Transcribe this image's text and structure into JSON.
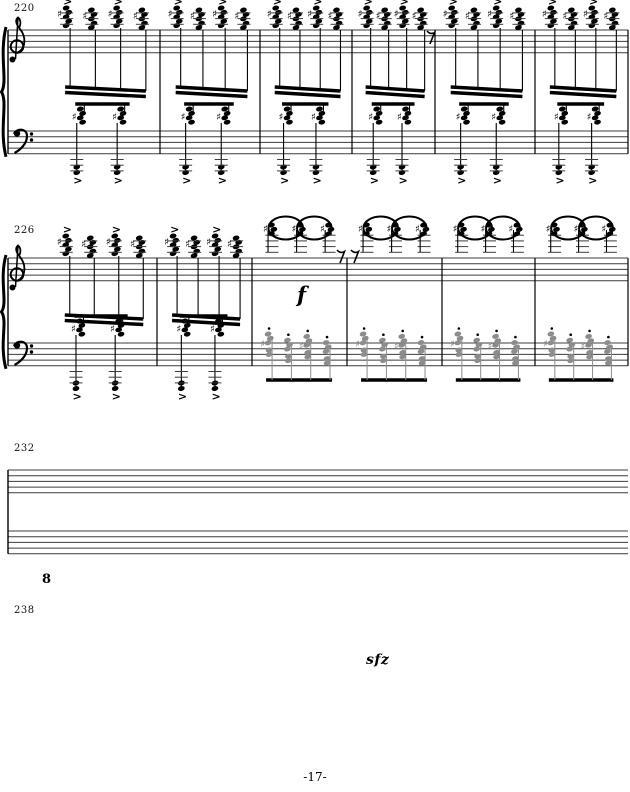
{
  "page": {
    "label": "-17-",
    "width": 630,
    "height": 792,
    "background": "#ffffff",
    "ink": "#000000",
    "gray_ink": "#8c8c8c",
    "staff_color": "#3c3c3c"
  },
  "dynamics": {
    "f": {
      "label": "f"
    },
    "sfz": {
      "label": "sfz"
    }
  },
  "icons": {
    "treble_clef": "treble-clef",
    "bass_clef": "bass-clef",
    "brace": "grand-staff-brace",
    "sharp": "sharp-sign",
    "accent": "accent-mark",
    "staccato": "staccato-dot",
    "eighth_rest": "eighth-rest"
  },
  "systems": [
    {
      "measure_number": "220",
      "treble_top": 30,
      "bass_top": 131,
      "content_left": 48,
      "oct_drop": 36,
      "barlines": [
        160,
        260,
        352,
        435,
        535,
        628
      ],
      "rests": [
        {
          "x": 427,
          "y": 31
        }
      ],
      "measures": [
        {
          "treble": "chords",
          "bass": "accent_oct"
        },
        {
          "treble": "chords",
          "bass": "accent_oct"
        },
        {
          "treble": "chords",
          "bass": "accent_oct"
        },
        {
          "treble": "chords",
          "bass": "accent_oct"
        },
        {
          "treble": "chords",
          "bass": "accent_oct"
        },
        {
          "treble": "chords",
          "bass": "accent_oct"
        }
      ]
    },
    {
      "measure_number": "226",
      "treble_top": 258,
      "bass_top": 343,
      "content_left": 48,
      "oct_drop": 40,
      "barlines": [
        157,
        252,
        347,
        442,
        535,
        628
      ],
      "rests": [
        {
          "x": 337,
          "y": 250
        },
        {
          "x": 351,
          "y": 250
        }
      ],
      "measures": [
        {
          "treble": "chords",
          "bass": "accent_oct"
        },
        {
          "treble": "chords",
          "bass": "accent_oct"
        },
        {
          "treble": "high_ties",
          "bass": "gray_stacc"
        },
        {
          "treble": "high_ties",
          "bass": "gray_stacc"
        },
        {
          "treble": "high_ties",
          "bass": "gray_stacc"
        },
        {
          "treble": "high_ties",
          "bass": "gray_stacc"
        }
      ]
    },
    {
      "measure_number": "232",
      "treble_top": 470,
      "bass_top": 531,
      "content_left": 48,
      "oct_drop": 40,
      "ottava": {
        "label": "",
        "segments": [
          {
            "x1": 148,
            "x2": 330,
            "y": 426,
            "tick": true
          },
          {
            "x1": 342,
            "x2": 628,
            "y": 426,
            "tick": false
          }
        ]
      },
      "measures": [
        {
          "treble": "loops",
          "bass": "gray_stacc"
        },
        {
          "treble": "run16",
          "bass": "gray_stacc"
        },
        {
          "treble": "run16",
          "bass": "gray_stacc"
        },
        {
          "treble": "run16",
          "bass": "gray_stacc"
        },
        {
          "treble": "loops",
          "bass": "gray_stacc"
        },
        {
          "treble": "run16",
          "bass": "gray_stacc"
        }
      ]
    },
    {
      "measure_number": "238",
      "treble_top": 630,
      "bass_top": 697,
      "content_left": 48,
      "oct_drop": 52,
      "ottava": {
        "label": "8",
        "segments": [
          {
            "x1": 58,
            "x2": 292,
            "y": 583,
            "tick": true
          },
          {
            "x1": 310,
            "x2": 628,
            "y": 598,
            "tick": false
          }
        ]
      },
      "measures": [
        {
          "treble": "run16",
          "bass": "gray_stacc"
        },
        {
          "treble": "run16",
          "bass": "gray_stacc"
        },
        {
          "treble": "high_ties",
          "bass": "gray_stacc"
        },
        {
          "treble": "run16b",
          "bass": "accent_oct"
        },
        {
          "treble": "run16b",
          "bass": "accent_oct"
        },
        {
          "treble": "run16b",
          "bass": "accent_oct"
        }
      ]
    }
  ]
}
